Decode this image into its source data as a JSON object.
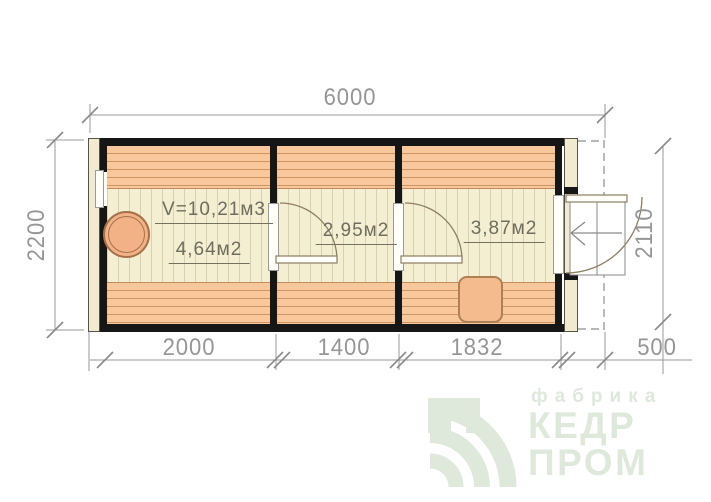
{
  "dimensions": {
    "width_total": "6000",
    "height_left": "2200",
    "height_right": "2110",
    "bottom_segments": [
      "2000",
      "1400",
      "1832",
      "500"
    ]
  },
  "rooms": [
    {
      "volume": "V=10,21м3",
      "area": "4,64м2"
    },
    {
      "area": "2,95м2"
    },
    {
      "area": "3,87м2"
    }
  ],
  "logo": {
    "tagline": "фабрика",
    "name_line1": "КЕДР",
    "name_line2": "ПРОМ"
  },
  "colors": {
    "bench": "#f8c79b",
    "floor": "#f4eed3",
    "stove": "#f2b286",
    "wall": "#161616",
    "dimension_text": "#969696",
    "room_text": "#6f6e5e",
    "watermark": "#dee9dc"
  }
}
